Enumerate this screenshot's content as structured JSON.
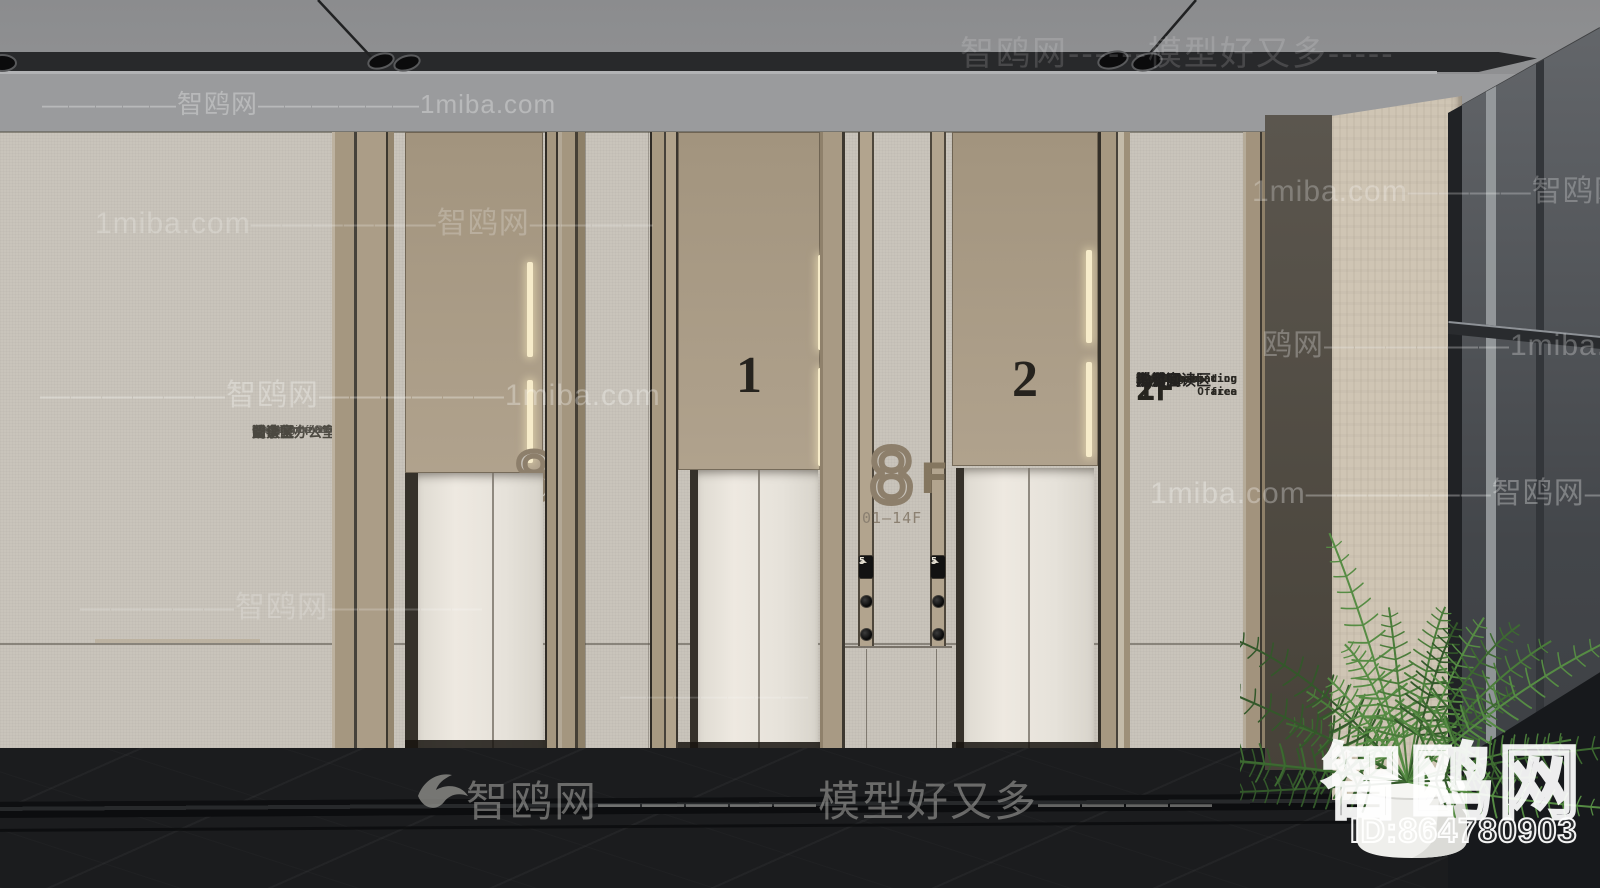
{
  "watermarks": {
    "ceiling_row": "智鸥网------模型好又多-----",
    "beam_row": "—————智鸥网——————1miba.com",
    "wall_row_1": "1miba.com——————智鸥网————",
    "wall_row_1r": "1miba.com————智鸥网———",
    "wall_row_2": "——————智鸥网——————1miba.com",
    "wall_row_2r": "鸥网——————1miba.com———",
    "wall_row_3": "—————智鸥网—————",
    "wall_row_3r": "1miba.com——————智鸥网————",
    "center_dashes": "———————",
    "floor_row": "智鸥网—————模型好又多————",
    "corner_brand": "智鸥网",
    "corner_id": "ID:864780903"
  },
  "left_directory": {
    "items": [
      {
        "en": "Chairman's Office",
        "zh": "董事长办公室"
      },
      {
        "en": "Negotiation area",
        "zh": "洽谈区"
      },
      {
        "en": "Conference Room",
        "zh": "会议室"
      },
      {
        "en": "Finance Office",
        "zh": "财务室"
      },
      {
        "en": "Reading area",
        "zh": "阅读区"
      }
    ]
  },
  "right_directory": {
    "sections": [
      {
        "floor": "2F",
        "items": [
          {
            "en": "Model Room",
            "zh": "样板间"
          },
          {
            "en": "Office",
            "zh": "办公室"
          }
        ]
      },
      {
        "floor": "1F",
        "items": [
          {
            "en": "Negotiation area",
            "zh": "洽谈区"
          },
          {
            "en": "Step reading area",
            "zh": "阶梯阅读区"
          },
          {
            "en": "Accounting Office",
            "zh": "财务室"
          },
          {
            "en": "Bathroom",
            "zh": "洗手间"
          }
        ]
      }
    ]
  },
  "elevators": {
    "center_sign": {
      "number": "8",
      "suffix": "F",
      "range": "01—14F"
    },
    "left_sign": {
      "number": "8",
      "range": "01"
    },
    "door_1_label": "1",
    "door_2_label": "2",
    "indicator": "5"
  },
  "colors": {
    "wall": "#c9c4bb",
    "panel_tan": "#ab9d88",
    "door": "#e9e5dd",
    "floor": "#1b1c1e",
    "led": "#f7ecca",
    "plant": "#4a7c3a"
  }
}
